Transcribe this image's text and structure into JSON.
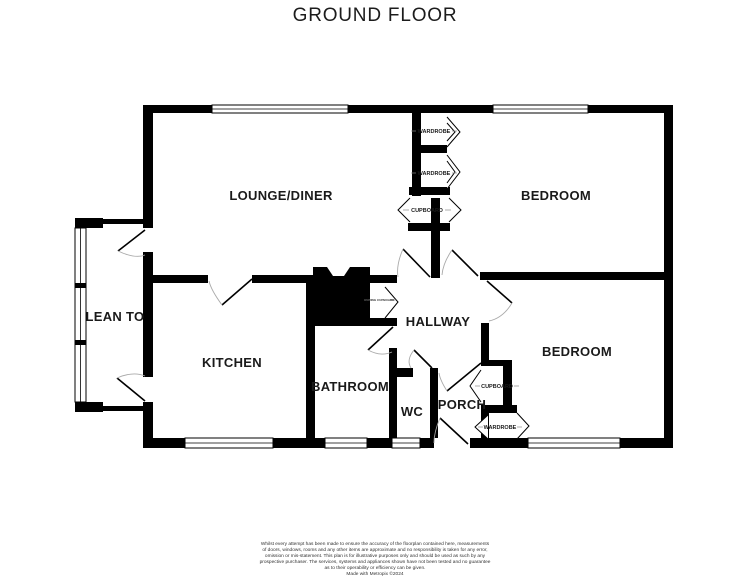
{
  "title": "GROUND FLOOR",
  "plan": {
    "rooms": {
      "lounge_diner": "LOUNGE/DINER",
      "bedroom_top": "BEDROOM",
      "bedroom_bottom": "BEDROOM",
      "lean_to": "LEAN TO",
      "kitchen": "KITCHEN",
      "hallway": "HALLWAY",
      "bathroom": "BATHROOM",
      "wc": "WC",
      "porch": "PORCH"
    },
    "fixtures": {
      "wardrobe_1": "WARDROBE",
      "wardrobe_2": "WARDROBE",
      "cupboard_hall": "CUPBOARD",
      "cupboard_porch": "CUPBOARD",
      "wardrobe_porch": "WARDROBE",
      "airing_cupboard": "AIRING CUPBOARD"
    },
    "colors": {
      "wall": "#000000",
      "door_arc": "#aaaaaa",
      "label": "#1a1a1a",
      "background": "#ffffff"
    }
  },
  "footer": {
    "lines": [
      "Whilst every attempt has been made to ensure the accuracy of the floorplan contained here, measurements",
      "of doors, windows, rooms and any other items are approximate and no responsibility is taken for any error,",
      "omission or mis-statement. This plan is for illustrative purposes only and should be used as such by any",
      "prospective purchaser. The services, systems and appliances shown have not been tested and no guarantee",
      "as to their operability or efficiency can be given.",
      "Made with Metropix ©2024"
    ]
  }
}
